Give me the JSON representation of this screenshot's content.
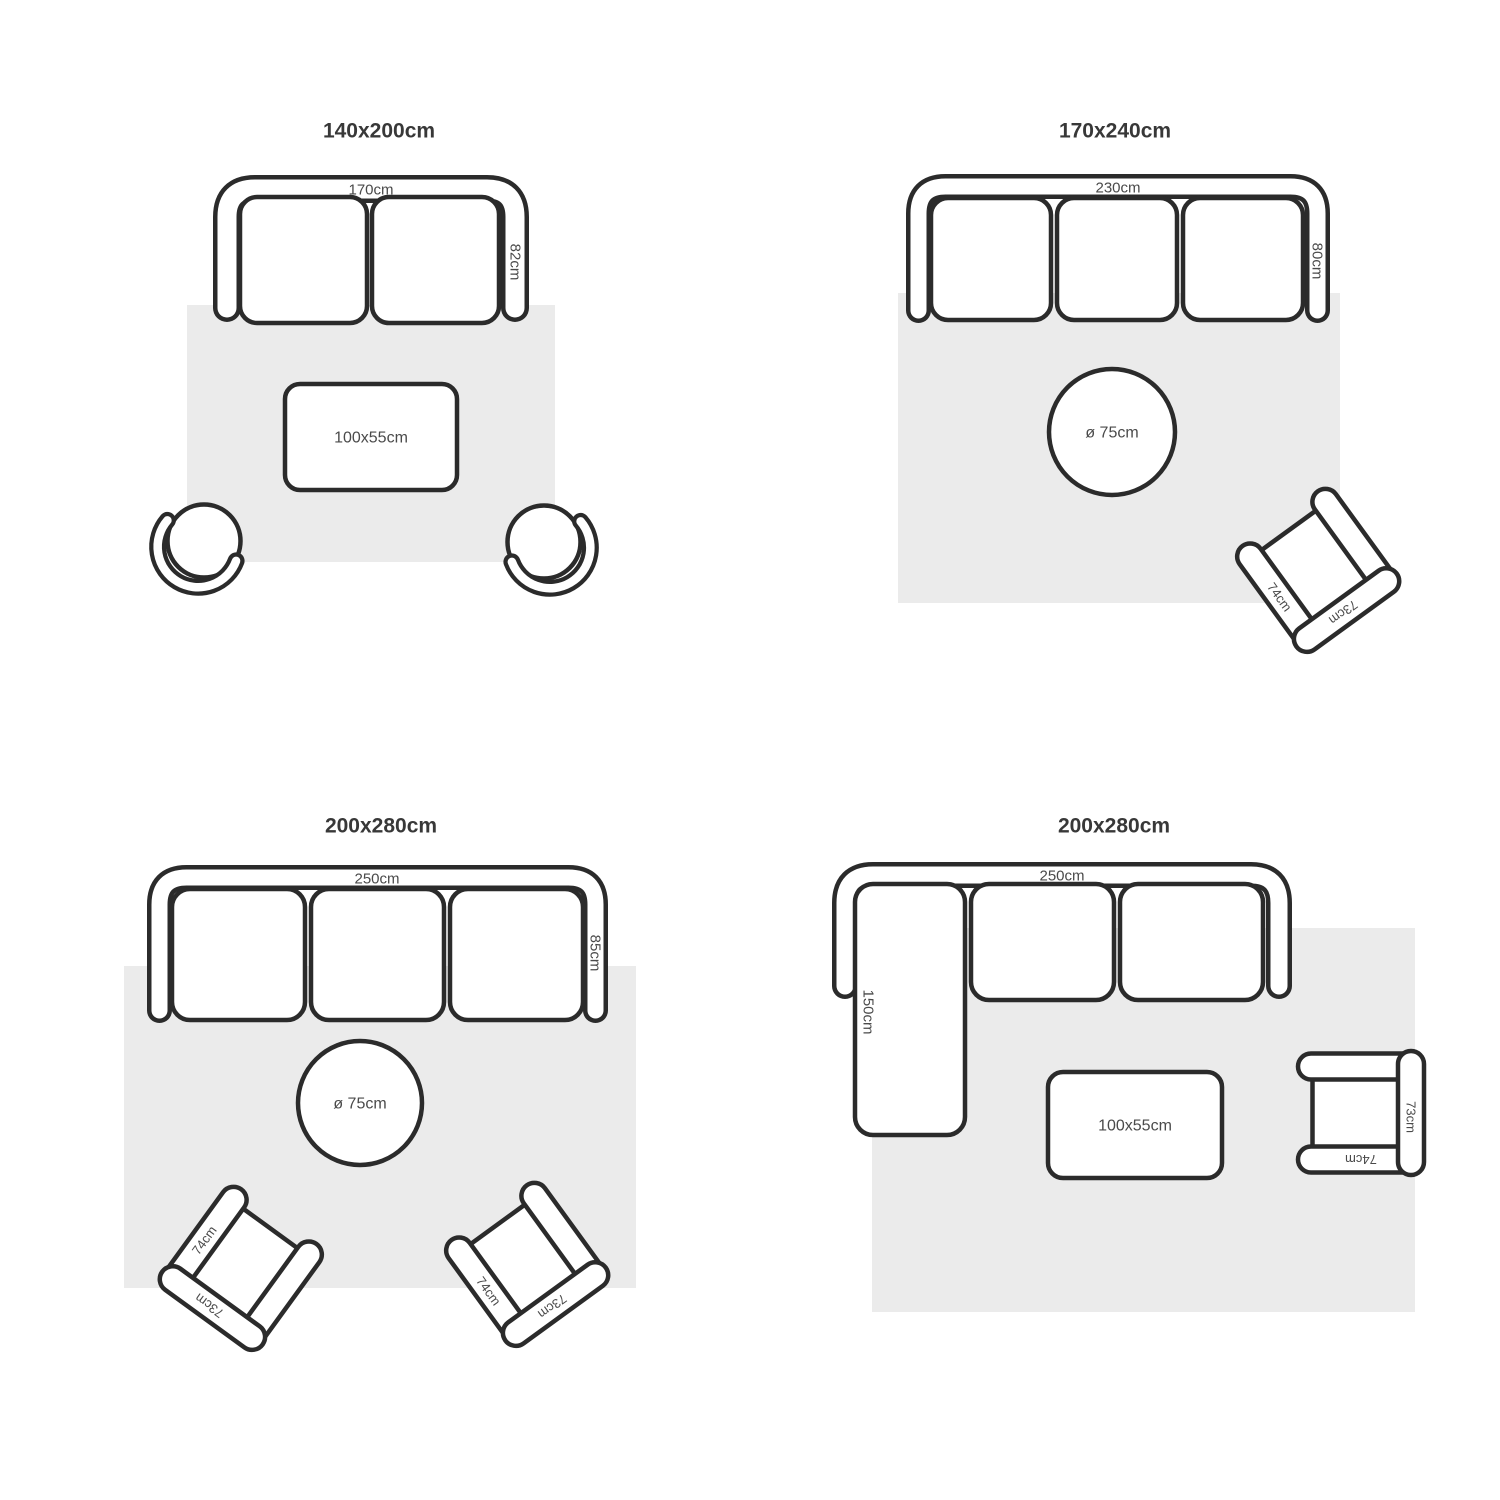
{
  "colors": {
    "background": "#ffffff",
    "outline": "#2b2b2b",
    "rug": "#ebebeb",
    "title_text": "#383838",
    "label_text": "#4a4a4a"
  },
  "layouts": [
    {
      "title": "140x200cm",
      "sofa": {
        "seats": 2,
        "width_label": "170cm",
        "depth_label": "82cm"
      },
      "coffee_table": {
        "label": "100x55cm"
      }
    },
    {
      "title": "170x240cm",
      "sofa": {
        "seats": 3,
        "width_label": "230cm",
        "depth_label": "80cm"
      },
      "round_table": {
        "label": "ø 75cm"
      },
      "armchair": {
        "arm_label": "74cm",
        "back_label": "73cm"
      }
    },
    {
      "title": "200x280cm",
      "sofa": {
        "seats": 3,
        "width_label": "250cm",
        "depth_label": "85cm"
      },
      "round_table": {
        "label": "ø 75cm"
      },
      "armchair_left": {
        "arm_label": "74cm",
        "back_label": "73cm"
      },
      "armchair_right": {
        "arm_label": "74cm",
        "back_label": "73cm"
      }
    },
    {
      "title": "200x280cm",
      "sofa": {
        "type": "sectional",
        "seats": 2,
        "width_label": "250cm",
        "chaise_label": "150cm"
      },
      "coffee_table": {
        "label": "100x55cm"
      },
      "armchair": {
        "arm_label": "74cm",
        "back_label": "73cm"
      }
    }
  ]
}
